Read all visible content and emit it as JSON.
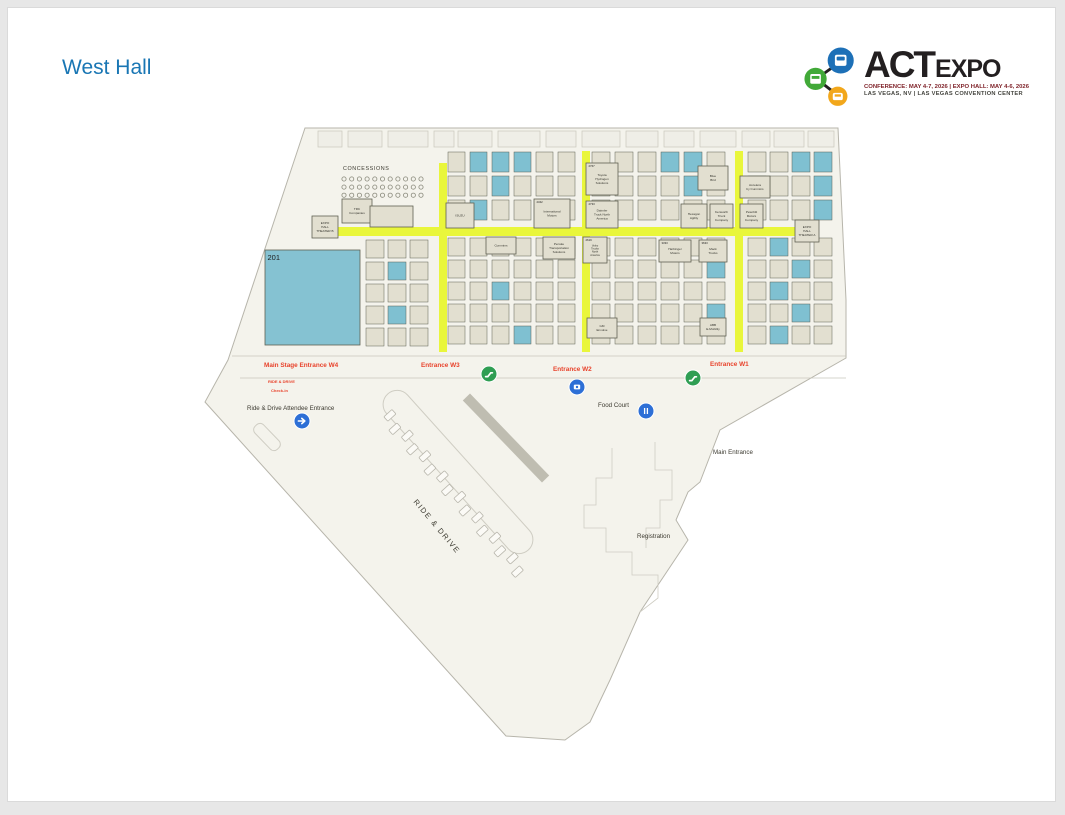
{
  "page": {
    "title": "West Hall",
    "title_color": "#1976b4"
  },
  "logo": {
    "act": "ACT",
    "expo": "EXPO",
    "tagline1": "CONFERENCE: MAY 4-7, 2026 | EXPO HALL: MAY 4-6, 2026",
    "tagline2": "LAS VEGAS, NV | LAS VEGAS CONVENTION CENTER",
    "colors": {
      "blue": "#1d70b7",
      "green": "#41a938",
      "orange": "#f2a71b",
      "dark": "#231f20",
      "red": "#7d1f26",
      "gray": "#45453f"
    }
  },
  "map": {
    "colors": {
      "floor": "#f4f3ec",
      "outline": "#b7b5ab",
      "wall": "#c9c7bc",
      "room": "#efeee7",
      "booth": "#e2dfd0",
      "boothStroke": "#5f6152",
      "teal": "#7fc0d1",
      "teal201": "#85c2d2",
      "aisle": "#e9f63b",
      "red": "#e8432c",
      "dark": "#3c3a30",
      "markerBlue": "#2d6fd6",
      "markerGreen": "#2f9e53",
      "canopy": "#b5b3a7",
      "decor": "#cfcdc3",
      "stall": "#fbfaf6",
      "stallStroke": "#b9b7ad"
    },
    "footprint": "305,128 838,128 846,300 846,358 720,430 700,482 688,492 676,520 688,540 640,612 610,680 590,722 565,740 506,736 205,402 228,360",
    "walls": [
      [
        232,
        356,
        846,
        356
      ],
      [
        240,
        378,
        846,
        378
      ]
    ],
    "top_rooms": [
      [
        318,
        24
      ],
      [
        348,
        34
      ],
      [
        388,
        40
      ],
      [
        434,
        20
      ],
      [
        458,
        34
      ],
      [
        498,
        42
      ],
      [
        546,
        30
      ],
      [
        582,
        38
      ],
      [
        626,
        32
      ],
      [
        664,
        30
      ],
      [
        700,
        36
      ],
      [
        742,
        28
      ],
      [
        774,
        30
      ],
      [
        808,
        26
      ]
    ],
    "aisles": [
      [
        439,
        163,
        8,
        189
      ],
      [
        582,
        151,
        8,
        201
      ],
      [
        735,
        151,
        8,
        201
      ],
      [
        337,
        227,
        464,
        9
      ]
    ],
    "concessions": {
      "label_x": 343,
      "label_y": 170,
      "x": 344,
      "y": 179,
      "rows": 3,
      "cols": 11,
      "dx": 7.7,
      "dy": 8.1,
      "r": 2.1
    },
    "clusters": [
      {
        "x": 366,
        "y": 240,
        "cols": 3,
        "rows": 5,
        "cw": 18,
        "ch": 18,
        "gx": 4,
        "gy": 4,
        "teal": [
          4,
          10
        ]
      },
      {
        "x": 448,
        "y": 238,
        "cols": 6,
        "rows": 5,
        "cw": 17,
        "ch": 18,
        "gx": 5,
        "gy": 4,
        "teal": [
          14,
          27
        ]
      },
      {
        "x": 592,
        "y": 238,
        "cols": 6,
        "rows": 5,
        "cw": 18,
        "ch": 18,
        "gx": 5,
        "gy": 4,
        "teal": [
          11,
          23
        ]
      },
      {
        "x": 748,
        "y": 238,
        "cols": 4,
        "rows": 5,
        "cw": 18,
        "ch": 18,
        "gx": 4,
        "gy": 4,
        "teal": [
          1,
          6,
          9,
          14,
          17
        ]
      },
      {
        "x": 448,
        "y": 152,
        "cols": 6,
        "rows": 3,
        "cw": 17,
        "ch": 20,
        "gx": 5,
        "gy": 4,
        "teal": [
          1,
          2,
          3,
          8,
          13
        ]
      },
      {
        "x": 592,
        "y": 152,
        "cols": 6,
        "rows": 3,
        "cw": 18,
        "ch": 20,
        "gx": 5,
        "gy": 4,
        "teal": [
          3,
          4,
          10
        ]
      },
      {
        "x": 748,
        "y": 152,
        "cols": 4,
        "rows": 3,
        "cw": 18,
        "ch": 20,
        "gx": 4,
        "gy": 4,
        "teal": [
          2,
          3,
          7,
          11
        ]
      }
    ],
    "booths": [
      {
        "x": 265,
        "y": 250,
        "w": 95,
        "h": 95,
        "num": "201",
        "fill": "teal",
        "big": true,
        "lines": []
      },
      {
        "x": 342,
        "y": 199,
        "w": 30,
        "h": 24,
        "lines": [
          "TRC",
          "Companies"
        ]
      },
      {
        "x": 312,
        "y": 216,
        "w": 26,
        "h": 22,
        "lines": [
          "EXPO",
          "HALL",
          "THEATER B"
        ]
      },
      {
        "x": 370,
        "y": 206,
        "w": 43,
        "h": 21,
        "lines": []
      },
      {
        "x": 446,
        "y": 203,
        "w": 28,
        "h": 25,
        "lines": [
          "ISUZU"
        ]
      },
      {
        "x": 534,
        "y": 199,
        "w": 36,
        "h": 29,
        "num": "2342",
        "lines": [
          "International",
          "Motors"
        ]
      },
      {
        "x": 586,
        "y": 163,
        "w": 32,
        "h": 32,
        "num": "2767",
        "lines": [
          "Toyota",
          "Hydrogen",
          "Solutions"
        ]
      },
      {
        "x": 586,
        "y": 201,
        "w": 32,
        "h": 27,
        "num": "2733",
        "lines": [
          "Daimler",
          "Truck North",
          "America"
        ]
      },
      {
        "x": 698,
        "y": 166,
        "w": 30,
        "h": 24,
        "lines": [
          "Blue",
          "Bird"
        ]
      },
      {
        "x": 681,
        "y": 204,
        "w": 26,
        "h": 24,
        "lines": [
          "Hexagon",
          "Agility"
        ]
      },
      {
        "x": 710,
        "y": 204,
        "w": 23,
        "h": 24,
        "lines": [
          "Kenworth",
          "Truck",
          "Company"
        ]
      },
      {
        "x": 740,
        "y": 176,
        "w": 30,
        "h": 22,
        "lines": [
          "Accelera",
          "by Cummins"
        ]
      },
      {
        "x": 740,
        "y": 204,
        "w": 23,
        "h": 24,
        "lines": [
          "Peterbilt",
          "Motors",
          "Company"
        ]
      },
      {
        "x": 795,
        "y": 220,
        "w": 24,
        "h": 22,
        "lines": [
          "EXPO",
          "HALL",
          "THEATER A"
        ]
      },
      {
        "x": 486,
        "y": 237,
        "w": 30,
        "h": 17,
        "lines": [
          "Cummins"
        ]
      },
      {
        "x": 543,
        "y": 237,
        "w": 32,
        "h": 22,
        "lines": [
          "Penske",
          "Transportation",
          "Solutions"
        ]
      },
      {
        "x": 583,
        "y": 237,
        "w": 24,
        "h": 26,
        "num": "2619",
        "lines": [
          "Volvo",
          "Trucks",
          "North",
          "America"
        ]
      },
      {
        "x": 659,
        "y": 240,
        "w": 32,
        "h": 22,
        "num": "3333",
        "lines": [
          "Harbinger",
          "Motors"
        ]
      },
      {
        "x": 699,
        "y": 240,
        "w": 28,
        "h": 22,
        "num": "3633",
        "lines": [
          "Mack",
          "Trucks"
        ]
      },
      {
        "x": 587,
        "y": 318,
        "w": 30,
        "h": 20,
        "lines": [
          "GM",
          "Envolve"
        ]
      },
      {
        "x": 700,
        "y": 318,
        "w": 26,
        "h": 18,
        "lines": [
          "ABB",
          "E-Mobility"
        ]
      }
    ],
    "labels_red": [
      {
        "t": "Main Stage Entrance W4",
        "x": 264,
        "y": 367,
        "s": 6.4
      },
      {
        "t": "Entrance W3",
        "x": 421,
        "y": 367,
        "s": 6.4
      },
      {
        "t": "Entrance W2",
        "x": 553,
        "y": 371,
        "s": 6.4
      },
      {
        "t": "Entrance W1",
        "x": 710,
        "y": 366,
        "s": 6.4
      },
      {
        "t": "RIDE & DRIVE",
        "x": 268,
        "y": 383,
        "s": 4
      },
      {
        "t": "Check-in",
        "x": 271,
        "y": 392,
        "s": 4
      }
    ],
    "labels_dark": [
      {
        "t": "CONCESSIONS",
        "x": 343,
        "y": 170,
        "s": 5.4,
        "ls": 0.6
      },
      {
        "t": "Ride & Drive Attendee Entrance",
        "x": 247,
        "y": 410,
        "s": 6.2
      },
      {
        "t": "Food Court",
        "x": 598,
        "y": 407,
        "s": 6.2
      },
      {
        "t": "Main Entrance",
        "x": 713,
        "y": 454,
        "s": 6.2
      },
      {
        "t": "Registration",
        "x": 637,
        "y": 538,
        "s": 6.2
      }
    ],
    "rotated_label": {
      "t": "RIDE & DRIVE",
      "x": 435,
      "y": 528,
      "rotate": 50,
      "s": 7.5,
      "ls": 1.5
    },
    "markers": [
      {
        "type": "arrow",
        "x": 302,
        "y": 421,
        "color": "blue"
      },
      {
        "type": "escalator",
        "x": 489,
        "y": 374,
        "color": "green"
      },
      {
        "type": "escalator",
        "x": 693,
        "y": 378,
        "color": "green"
      },
      {
        "type": "camera",
        "x": 577,
        "y": 387,
        "color": "blue"
      },
      {
        "type": "utensils",
        "x": 646,
        "y": 411,
        "color": "blue"
      }
    ],
    "stalls": {
      "x": 388,
      "y": 417,
      "dx": 8.75,
      "dy": 10.2,
      "count": 16,
      "w": 6,
      "h": 11,
      "rotate": 48,
      "alt": 2.5
    },
    "decor": {
      "loop": {
        "tx": 458,
        "ty": 472,
        "rot": 48,
        "w": 210,
        "h": 28
      },
      "canopy": {
        "tx": 506,
        "ty": 438,
        "rot": 46,
        "w": 114,
        "h": 10
      },
      "checkin": {
        "tx": 267,
        "ty": 437,
        "rot": 46,
        "w": 32,
        "h": 12
      },
      "polylines": [
        "612,448 612,478 596,478 596,505 584,505 584,528 606,528 606,552 632,552 632,575 658,575 658,598 640,612",
        "655,442 655,470 672,470 672,500 660,500 660,528 646,528 646,548"
      ]
    }
  }
}
